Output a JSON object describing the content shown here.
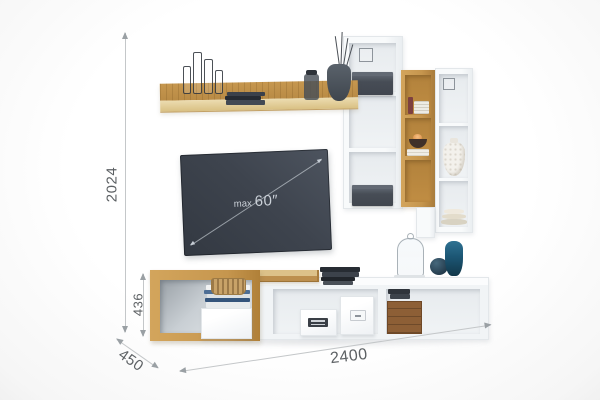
{
  "diagram": {
    "type": "wall-unit furniture dimension diagram",
    "background": "#fcfcfc"
  },
  "dims": {
    "total_height": "2024",
    "stand_height": "436",
    "depth": "450",
    "total_width": "2400"
  },
  "tv": {
    "max_label": "max",
    "size_label": "60″"
  },
  "palette": {
    "oak": "#c6964e",
    "oak_light": "#e8d7ac",
    "white_furniture": "#f4f6f8",
    "tv_screen": "#3f4550",
    "dim_line": "#c4c7c9",
    "dim_text": "#5d6164",
    "teal_vase": "#1e5a74",
    "crate_brown": "#8d5f36"
  },
  "decor": {
    "wall_shelf": [
      "wire-candleholders",
      "dark-book-stack",
      "glass-jar",
      "vase-with-branches"
    ],
    "unit_a": [
      "wire-cube",
      "storage-box-top",
      "storage-box-bottom"
    ],
    "unit_b": [
      "red-book",
      "magazine-stack",
      "candle-bowl",
      "white-book-stack"
    ],
    "unit_c": [
      "wire-square",
      "textured-white-vase",
      "plate-stack"
    ],
    "tv_stand": [
      "woven-basket",
      "blue-book-stack",
      "white-storage-box",
      "vented-white-box",
      "label-white-box",
      "wooden-crate",
      "dark-book-stack",
      "glass-cloche",
      "round-blue-vase",
      "tall-blue-vase"
    ]
  }
}
